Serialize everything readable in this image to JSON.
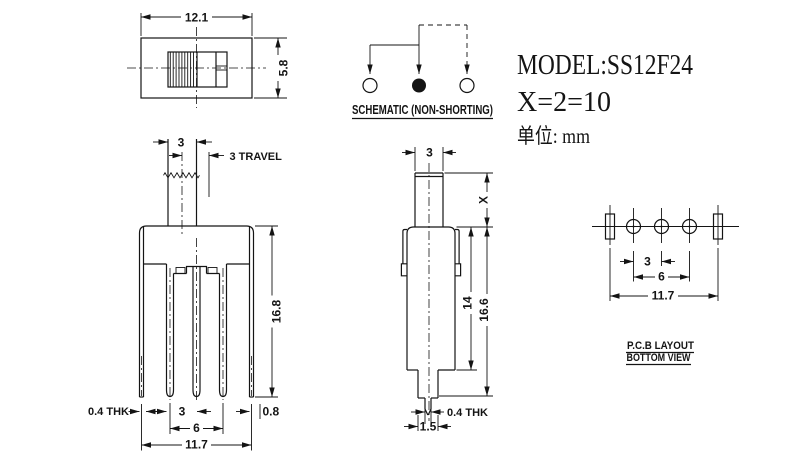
{
  "colors": {
    "ink": "#141414",
    "paper": "#ffffff"
  },
  "title_block": {
    "model": "MODEL:SS12F24",
    "x_spec": "X=2=10",
    "units": "单位: mm"
  },
  "schematic": {
    "caption": "SCHEMATIC (NON-SHORTING)"
  },
  "top_view": {
    "width": "12.1",
    "height": "5.8"
  },
  "front_view": {
    "knob_width": "3",
    "travel": "3 TRAVEL",
    "height": "16.8",
    "thickness": "0.4 THK",
    "pitch": "3",
    "edge": "0.8",
    "span": "6",
    "overall": "11.7"
  },
  "side_view": {
    "knob_width": "3",
    "knob_height": "X",
    "body_height": "14",
    "total_height": "16.6",
    "thickness": "0.4 THK",
    "tip_width": "1.5"
  },
  "pcb_layout": {
    "pitch": "3",
    "span": "6",
    "overall": "11.7",
    "caption1": "P.C.B LAYOUT",
    "caption2": "BOTTOM VIEW"
  }
}
